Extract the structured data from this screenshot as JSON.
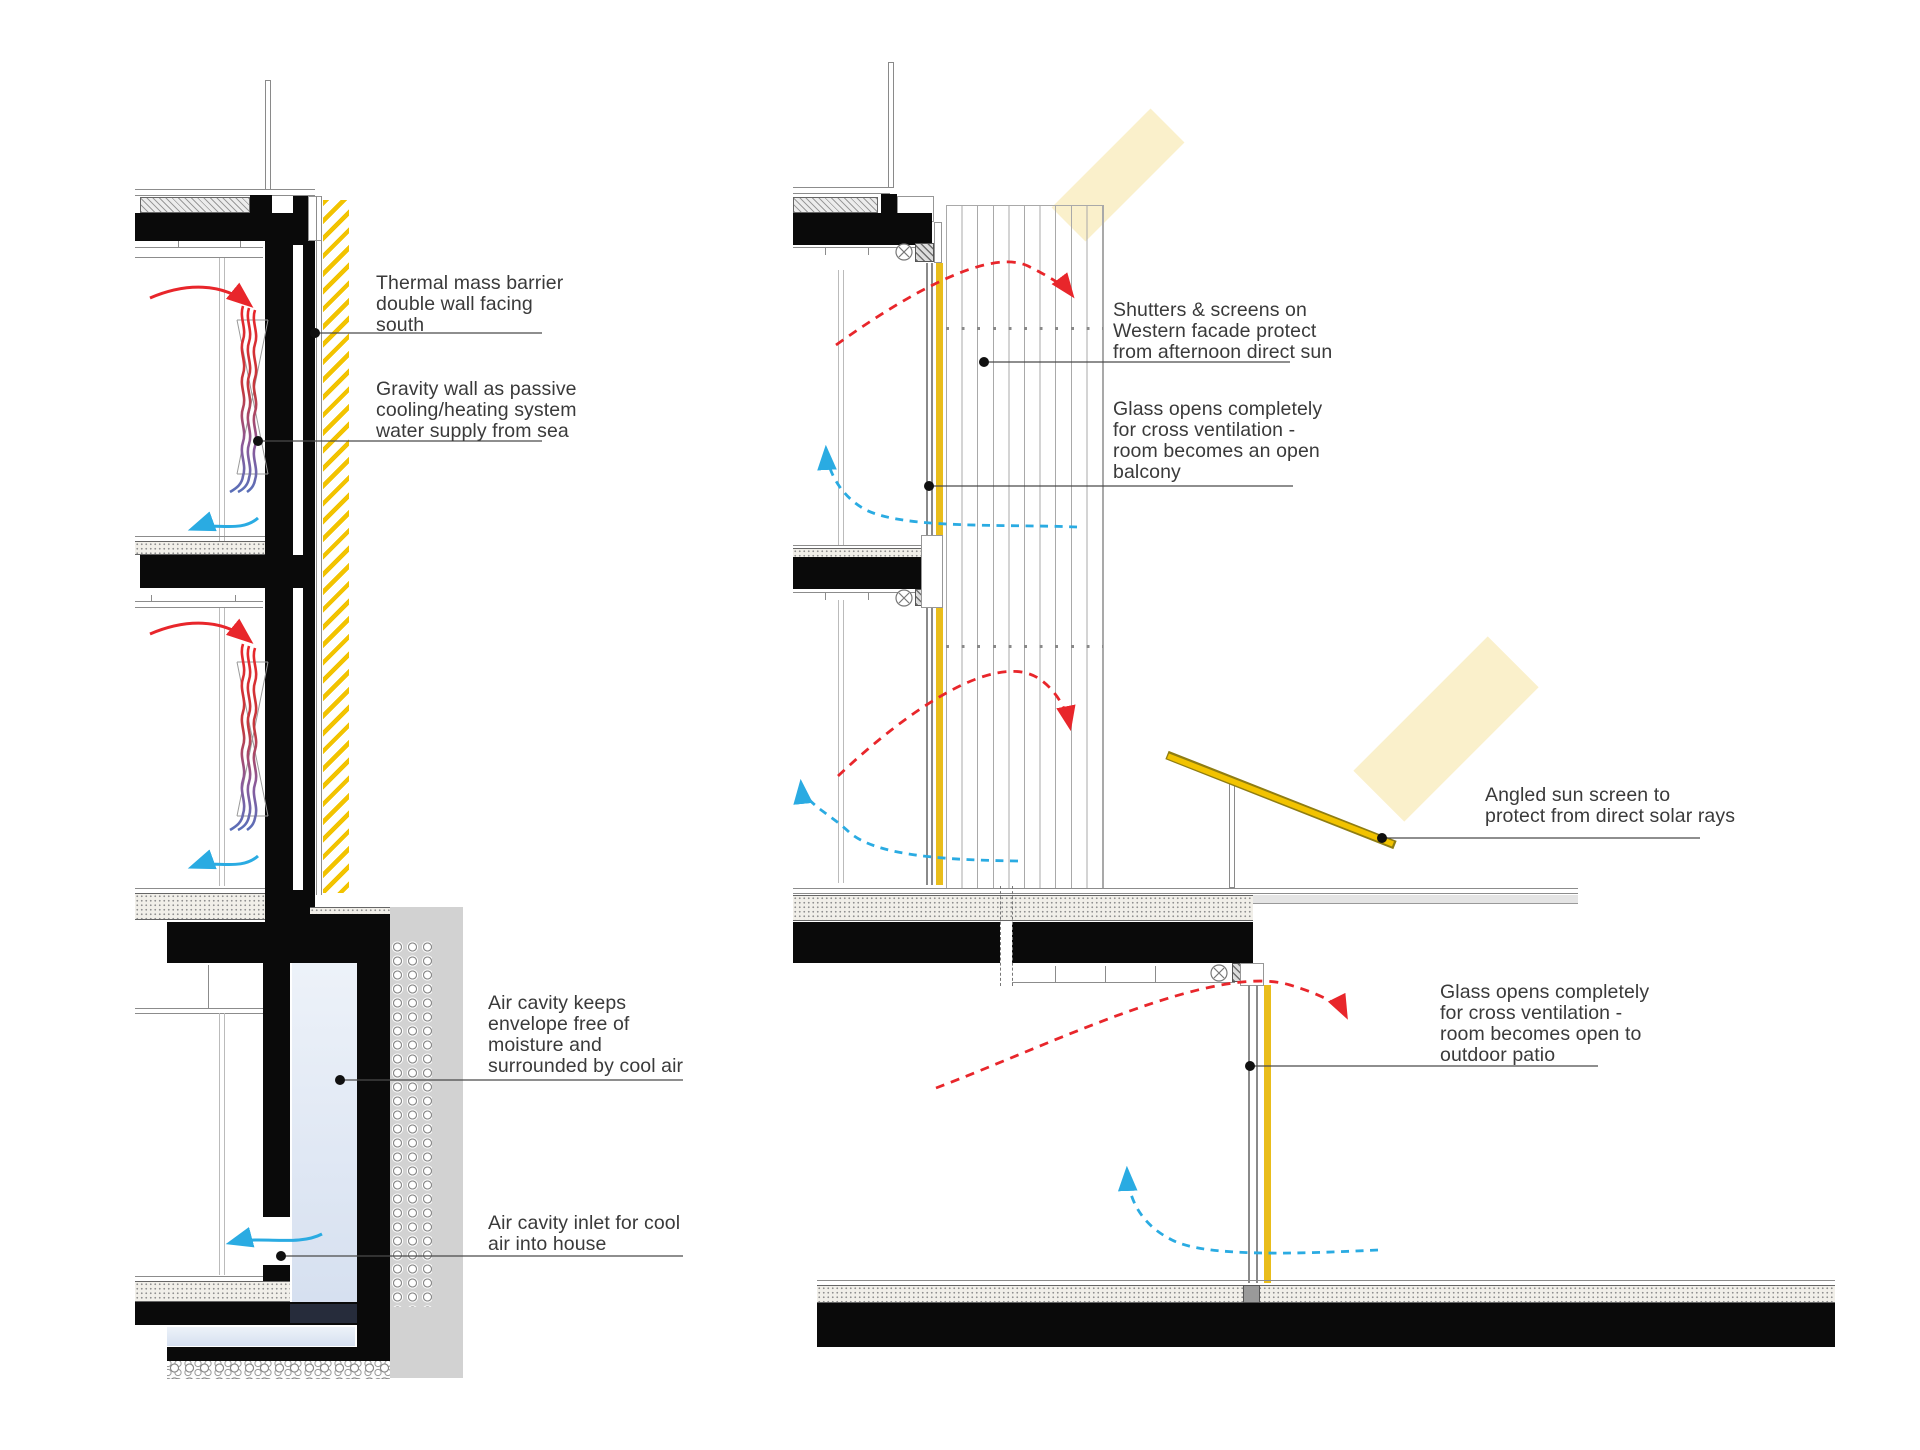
{
  "diagram": {
    "type": "architectural-passive-design-section",
    "colors": {
      "structure_black": "#0a0a0a",
      "warm_air_red": "#e8262b",
      "cool_air_blue": "#2aabe2",
      "solar_yellow": "#f2c300",
      "glass_yellow": "#e9bd1b",
      "sun_ray_cream": "#faf0cb",
      "air_cavity_blue": "#dce4f2",
      "ground_gray": "#d2d2d2",
      "annotation_ink": "#3a3a3a",
      "leader_line": "#4a4a4a"
    },
    "left_section": {
      "annotations": [
        {
          "id": "thermal-mass",
          "text": "Thermal mass barrier\ndouble wall facing\nsouth"
        },
        {
          "id": "gravity-wall",
          "text": "Gravity wall as passive\ncooling/heating system\nwater supply from sea"
        },
        {
          "id": "air-cavity",
          "text": "Air cavity keeps\nenvelope free of\nmoisture and\nsurrounded by cool air"
        },
        {
          "id": "air-cavity-inlet",
          "text": "Air cavity inlet for cool\nair into house"
        }
      ]
    },
    "right_section": {
      "annotations": [
        {
          "id": "shutters-screens",
          "text": "Shutters & screens on\nWestern facade protect\nfrom afternoon direct sun"
        },
        {
          "id": "glass-open-balcony",
          "text": "Glass opens completely\nfor cross ventilation -\nroom becomes an open\nbalcony"
        },
        {
          "id": "angled-sun-screen",
          "text": "Angled sun screen to\nprotect from direct solar rays"
        },
        {
          "id": "glass-open-patio",
          "text": "Glass opens completely\nfor cross ventilation -\nroom becomes open to\noutdoor patio"
        }
      ]
    }
  }
}
